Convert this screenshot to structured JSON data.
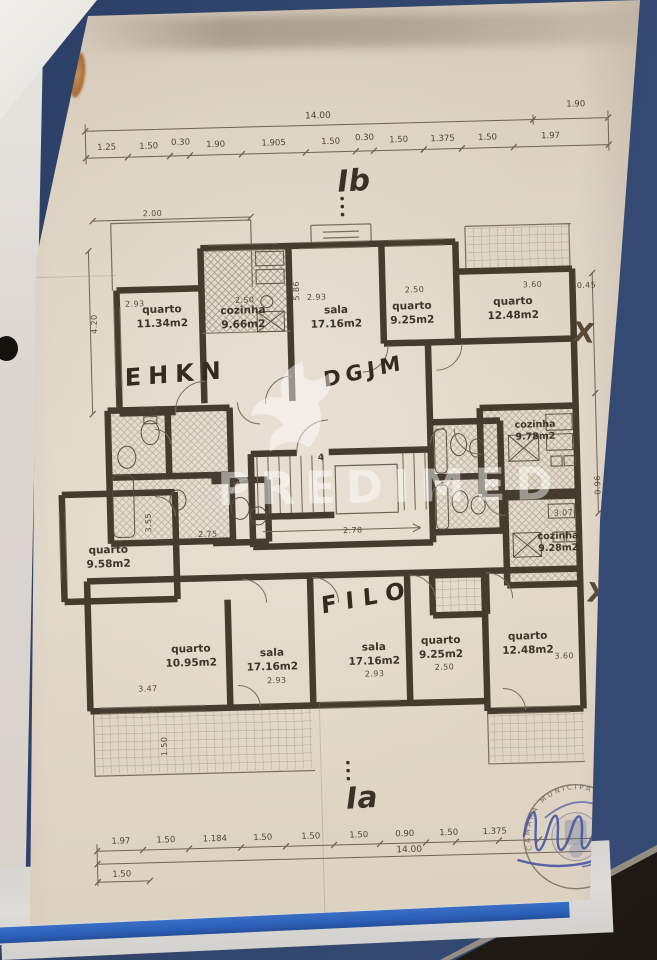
{
  "photo": {
    "background_color": "#32466d",
    "paper_color": "#ddd2c2",
    "ink_color": "#44392e",
    "folder_blue": "#2d62bb",
    "signature_blue": "#44519e",
    "rust_stain": "#a86a34"
  },
  "plan": {
    "section_labels": {
      "top": "Ib",
      "bottom": "Ia"
    },
    "bottom_sheet_text": "andares",
    "watermark": {
      "text": "PREDIMED",
      "logo": "bird-logo"
    },
    "stamp": {
      "text": "CÂMARA MUNICIPAL DE"
    },
    "annotations": [
      "EHKN",
      "DGJM",
      "FILO"
    ],
    "cross_marks": [
      "X",
      "X"
    ],
    "stair_label": "4",
    "rooms": [
      {
        "name": "quarto",
        "area": "11.34m2"
      },
      {
        "name": "cozinha",
        "area": "9.66m2"
      },
      {
        "name": "sala",
        "area": "17.16m2"
      },
      {
        "name": "quarto",
        "area": "9.25m2"
      },
      {
        "name": "quarto",
        "area": "12.48m2"
      },
      {
        "name": "cozinha",
        "area": "9.78m2"
      },
      {
        "name": "cozinha",
        "area": "9.28m2"
      },
      {
        "name": "quarto",
        "area": "9.58m2"
      },
      {
        "name": "quarto",
        "area": "10.95m2"
      },
      {
        "name": "sala",
        "area": "17.16m2"
      },
      {
        "name": "sala",
        "area": "17.16m2"
      },
      {
        "name": "quarto",
        "area": "9.25m2"
      },
      {
        "name": "quarto",
        "area": "12.48m2"
      }
    ],
    "dims_top": {
      "overall": "14.00",
      "right": "1.90",
      "segments": [
        "1.25",
        "1.50",
        "0.30",
        "1.90",
        "1.905",
        "1.50",
        "0.30",
        "1.50",
        "1.375",
        "1.50",
        "1.97"
      ]
    },
    "dims_bottom": {
      "overall": "14.00",
      "left_extra": "1.50",
      "segments": [
        "1.97",
        "1.50",
        "1.184",
        "1.50",
        "1.50",
        "1.50",
        "0.90",
        "1.50",
        "1.375"
      ]
    },
    "small_dims": [
      "2.00",
      "2.93",
      "2.50",
      "2.93",
      "2.50",
      "3.60",
      "0.45",
      "5.86",
      "4.20",
      "2.75",
      "3.07",
      "3.60",
      "2.93",
      "2.93",
      "2.50",
      "3.47",
      "0.45",
      "1.50",
      "3.55",
      "0.96",
      "0.15",
      "2.78"
    ]
  }
}
